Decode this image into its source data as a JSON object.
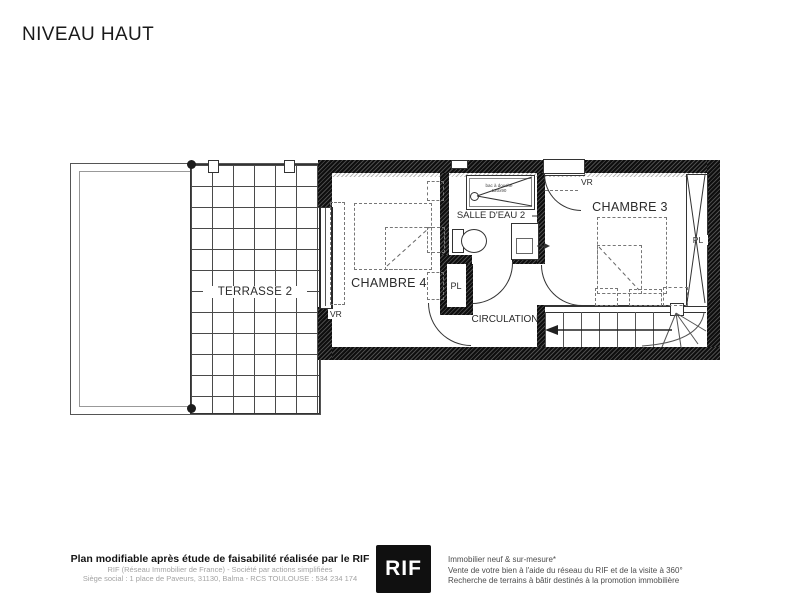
{
  "page": {
    "title": "NIVEAU HAUT"
  },
  "plan": {
    "terrasse_label": "TERRASSE 2",
    "chambre4_label": "CHAMBRE 4",
    "salle_deau_label": "SALLE D'EAU 2",
    "chambre3_label": "CHAMBRE 3",
    "circulation_label": "CIRCULATION",
    "pl_middle_label": "PL",
    "pl_chambre3_label": "PL",
    "vr_chambre4_label": "VR",
    "vr_chambre3_label": "VR",
    "shower_line1": "bac à douche",
    "shower_line2": "120x90"
  },
  "footer": {
    "left_bold": "Plan modifiable après étude de faisabilité réalisée par le RIF",
    "left_line2": "RIF (Réseau Immobilier de France) - Société par actions simplifiées",
    "left_line3": "Siège social : 1 place de Paveurs, 31130, Balma - RCS TOULOUSE : 534 234 174",
    "logo_text": "RIF",
    "right_line1": "Immobilier neuf & sur-mesure*",
    "right_line2": "Vente de votre bien à l'aide du réseau du RIF et de la visite à 360°",
    "right_line3": "Recherche de terrains à bâtir destinés à la promotion immobilière"
  },
  "colors": {
    "wall": "#1f1f1f",
    "line": "#333333",
    "logo_bg": "#101010"
  }
}
